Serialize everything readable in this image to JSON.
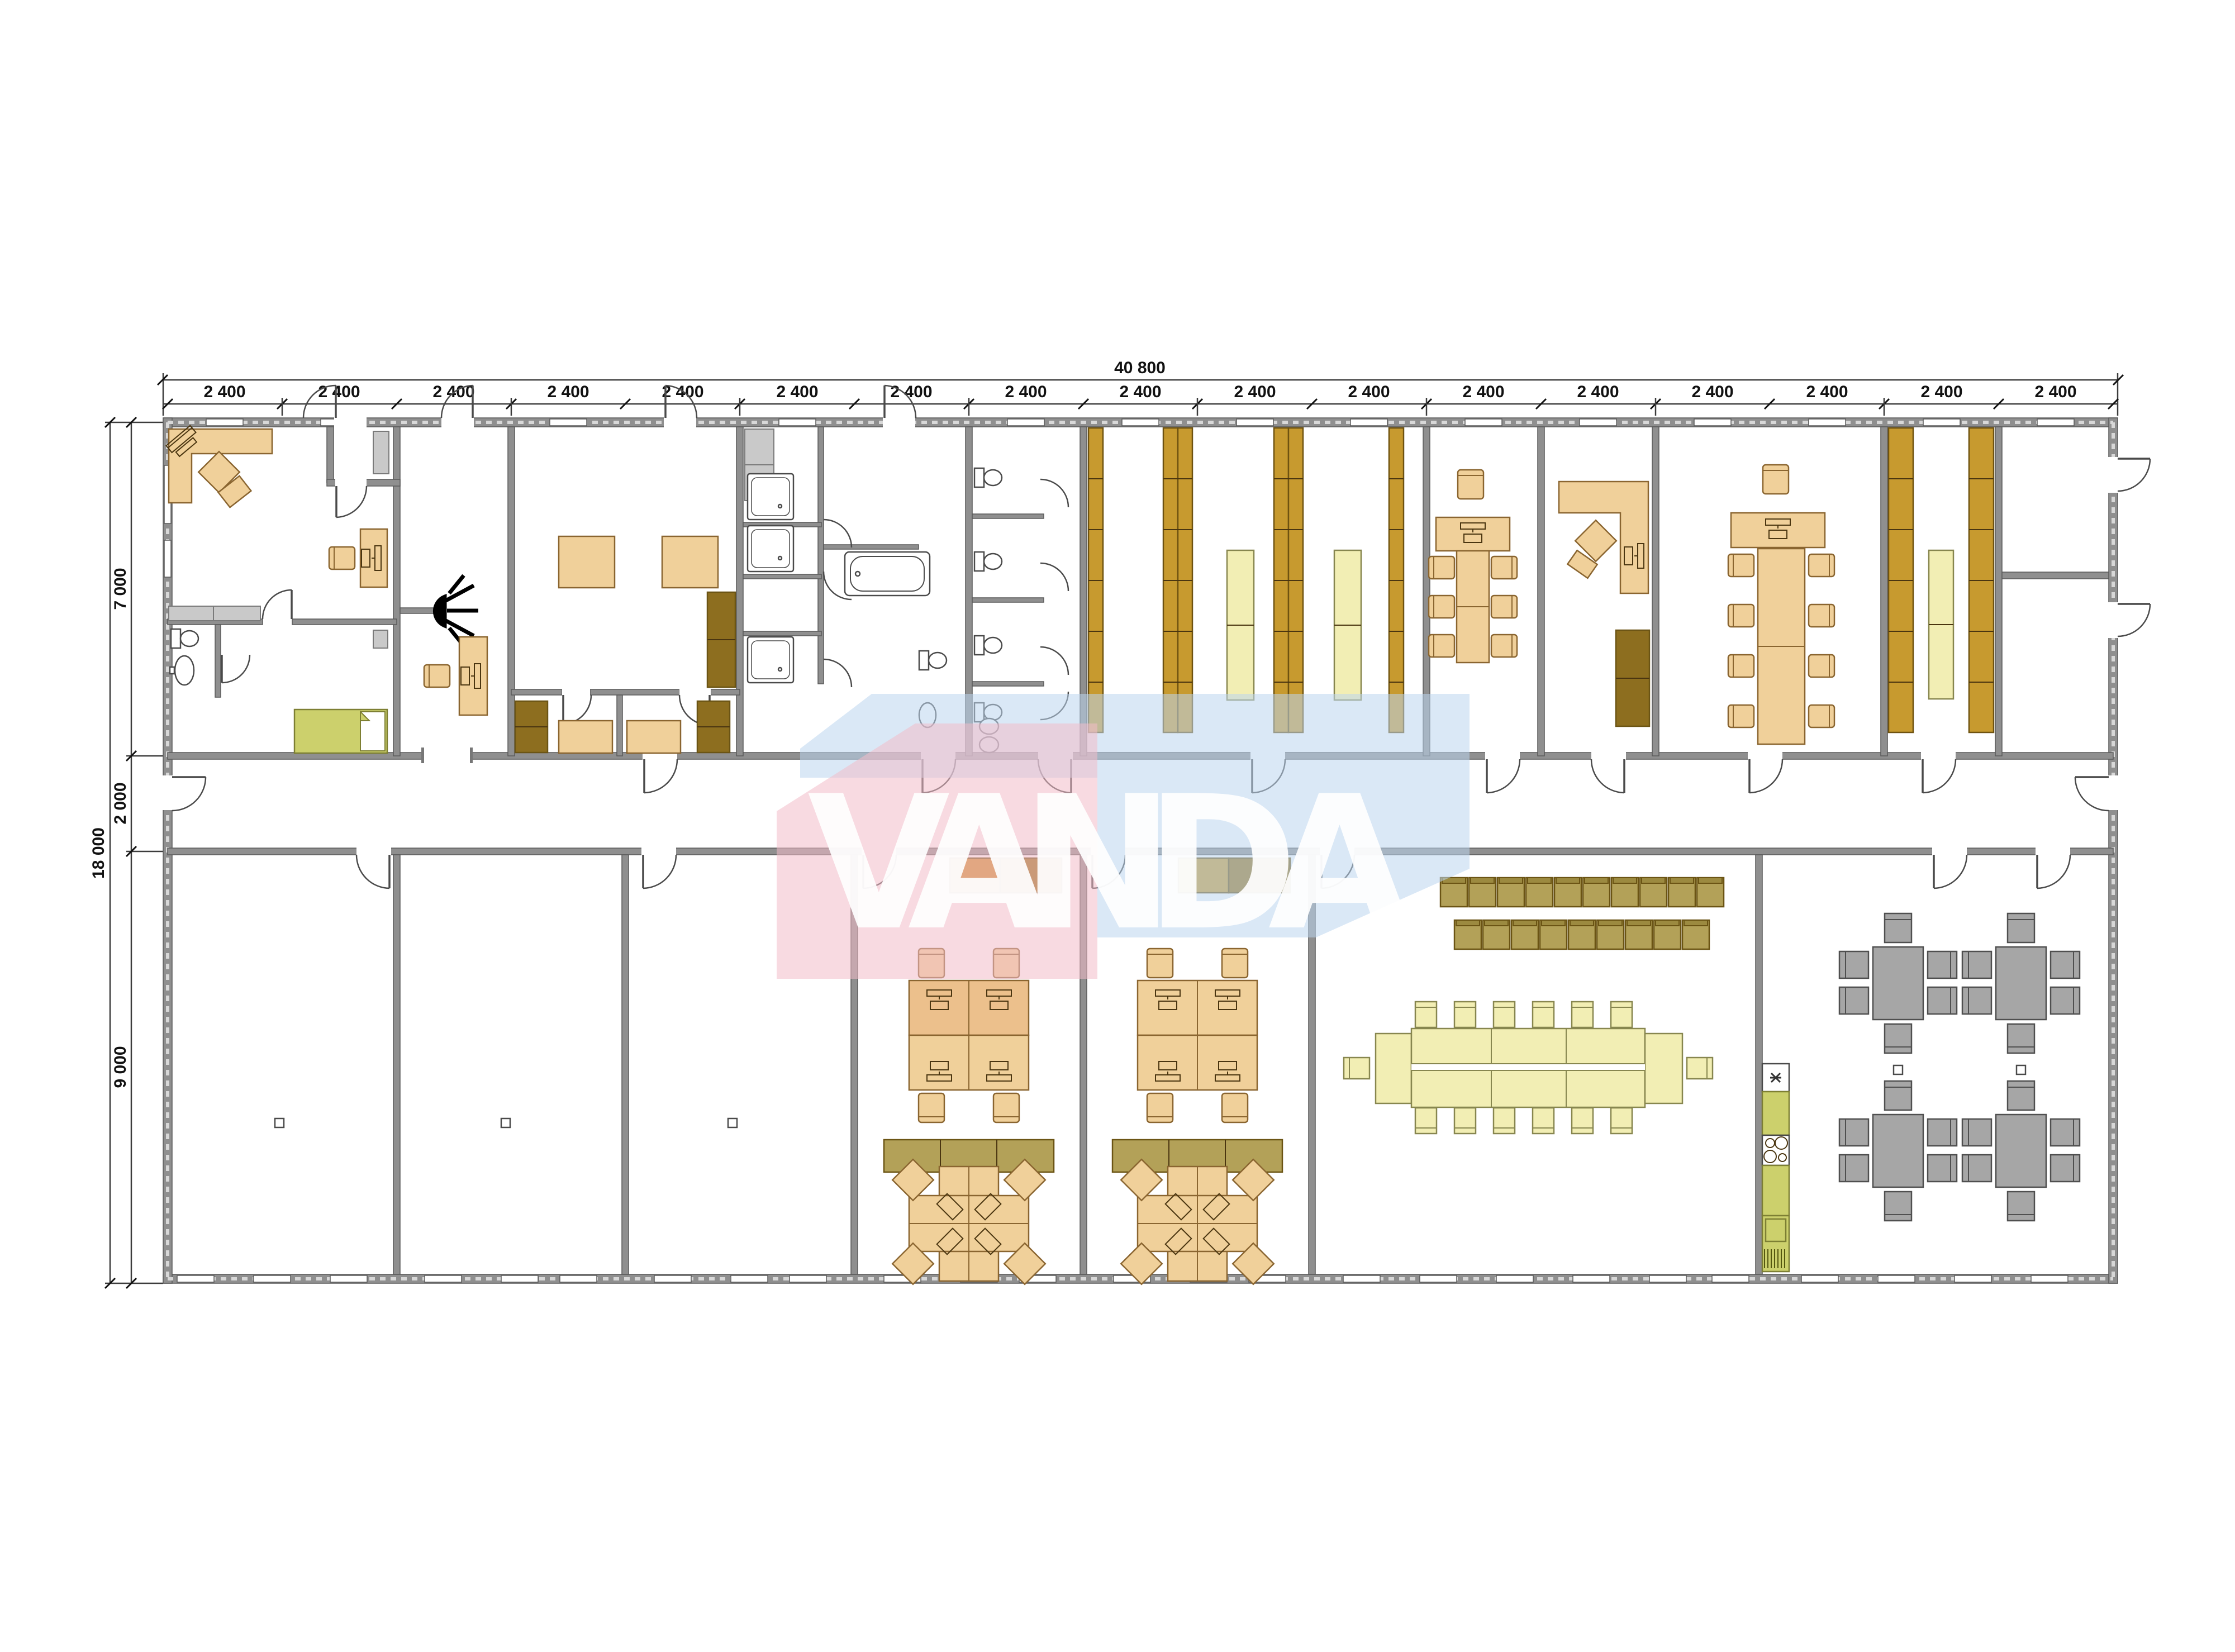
{
  "watermark": {
    "text": "VANDA",
    "pink": "#f2bcc8",
    "blue": "#bcd6ee",
    "text_color": "#ffffff"
  },
  "dimensions": {
    "top_total": "40 800",
    "top_segments": [
      "2 400",
      "2 400",
      "2 400",
      "2 400",
      "2 400",
      "2 400",
      "2 400",
      "2 400",
      "2 400",
      "2 400",
      "2 400",
      "2 400",
      "2 400",
      "2 400",
      "2 400",
      "2 400",
      "2 400"
    ],
    "left_total": "18 000",
    "left_segments": [
      "7 000",
      "2 000",
      "9 000"
    ]
  },
  "palette": {
    "wall": "#8f8f8f",
    "wallStroke": "#5a5a5a",
    "line": "#4a4a4a",
    "tan": "#f0d09a",
    "tanStroke": "#8a6530",
    "ochre": "#e9b877",
    "mustard": "#c79a2f",
    "mustardStroke": "#6e5210",
    "paleYellow": "#f2eeb4",
    "paleStroke": "#87864f",
    "brown": "#b3a158",
    "brownDark": "#6b5414",
    "sofa": "#8d6e1f",
    "green": "#ccd06c",
    "greenStroke": "#7d7f33",
    "grayFurn": "#a6a6a6",
    "grayFurnStroke": "#4f4f4f",
    "grayCab": "#c9c9c9",
    "pink": "#f2bcc8",
    "blue": "#bcd6ee",
    "white": "#ffffff",
    "dimText": "#111111",
    "dimLine": "#3c3c3c"
  }
}
